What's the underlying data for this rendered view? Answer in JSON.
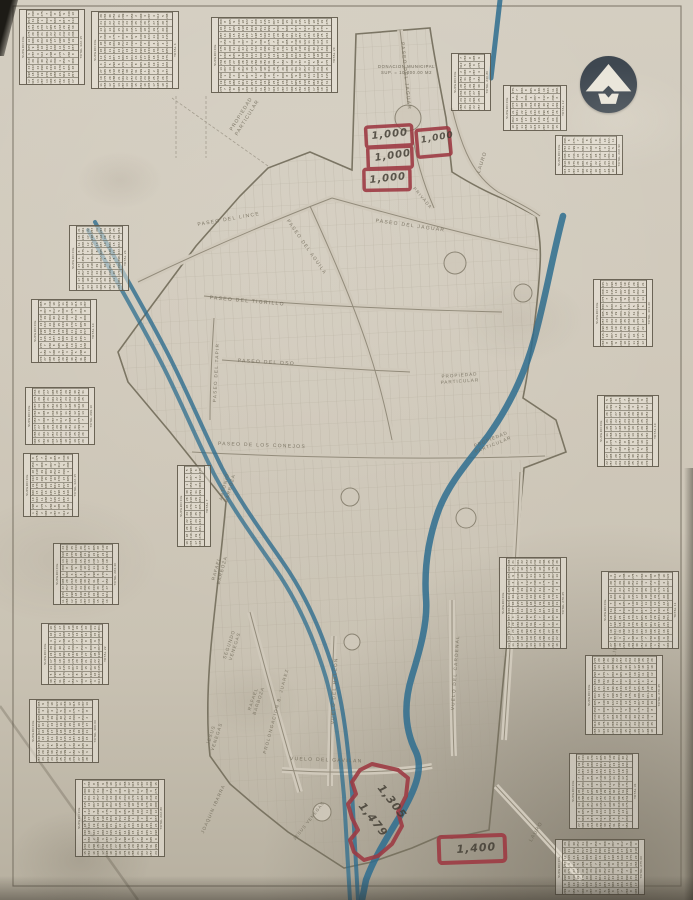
{
  "title_note": {
    "text": "DONACION MUNICIPAL\nSUP. = 10,000.00 M2",
    "x": 378,
    "y": 64,
    "size": 4.2
  },
  "colors": {
    "paper": "#d0c9bb",
    "map_line": "#847d6c",
    "stream_blue": "#2e6d8f",
    "marker_red": "#9d3a43",
    "handwriting": "#443f35",
    "logo": "#3e4750",
    "table_ink": "#49432f"
  },
  "logo": {
    "icon": "arrow-up-emblem"
  },
  "streets": [
    {
      "label": "PASEO DEL JAGUAR",
      "x": 404,
      "y": 42,
      "rot": 84,
      "size": 4.8
    },
    {
      "label": "PASEO DEL LINCE",
      "x": 197,
      "y": 222,
      "rot": -10,
      "size": 5
    },
    {
      "label": "PASEO DEL JAGUAR",
      "x": 376,
      "y": 218,
      "rot": 8,
      "size": 5
    },
    {
      "label": "PRIVADA",
      "x": 416,
      "y": 186,
      "rot": 50,
      "size": 4.2
    },
    {
      "label": "PASEO DEL AGUILA",
      "x": 289,
      "y": 219,
      "rot": 55,
      "size": 4.8
    },
    {
      "label": "PASEO DEL TIGRILLO",
      "x": 210,
      "y": 295,
      "rot": 5,
      "size": 5
    },
    {
      "label": "PASEO DEL TAPIR",
      "x": 212,
      "y": 402,
      "rot": -87,
      "size": 4.6
    },
    {
      "label": "PASEO DEL OSO",
      "x": 238,
      "y": 358,
      "rot": 3,
      "size": 5
    },
    {
      "label": "PASEO DE LOS CONEJOS",
      "x": 218,
      "y": 441,
      "rot": 2,
      "size": 5
    },
    {
      "label": "PROLONGACION B. JUAREZ",
      "x": 262,
      "y": 753,
      "rot": -75,
      "size": 4.4
    },
    {
      "label": "VUELO DEL HALCON",
      "x": 330,
      "y": 724,
      "rot": -87,
      "size": 4.6
    },
    {
      "label": "VUELO DEL GAVILAN",
      "x": 290,
      "y": 756,
      "rot": 2,
      "size": 5
    },
    {
      "label": "VUELO DEL CARDENAL",
      "x": 450,
      "y": 710,
      "rot": -86,
      "size": 4.6
    }
  ],
  "owners": [
    {
      "name": "PROPIEDAD\nPARTICULAR",
      "x": 228,
      "y": 130,
      "rot": -58,
      "size": 5
    },
    {
      "name": "LAURO",
      "x": 476,
      "y": 172,
      "rot": -72,
      "size": 5
    },
    {
      "name": "PROPIEDAD\nPARTICULAR",
      "x": 440,
      "y": 374,
      "rot": -4,
      "size": 4.6
    },
    {
      "name": "PROPIEDAD\nPARTICULAR",
      "x": 472,
      "y": 444,
      "rot": -22,
      "size": 4.6
    },
    {
      "name": "ANTONIO\nBARBOZA",
      "x": 218,
      "y": 500,
      "rot": -75,
      "size": 4.6
    },
    {
      "name": "RAFAEL\nBARBOZA",
      "x": 210,
      "y": 582,
      "rot": -75,
      "size": 4.6
    },
    {
      "name": "SEGUNDO\nVENEGAS",
      "x": 222,
      "y": 658,
      "rot": -72,
      "size": 4.6
    },
    {
      "name": "RAFAEL\nBARBOZA",
      "x": 246,
      "y": 712,
      "rot": -72,
      "size": 4.6
    },
    {
      "name": "JESUS\nVENEGAS",
      "x": 204,
      "y": 748,
      "rot": -72,
      "size": 4.6
    },
    {
      "name": "JOAQUIN IBARRA",
      "x": 200,
      "y": 832,
      "rot": -66,
      "size": 4.6
    },
    {
      "name": "JESUS VENEGAS",
      "x": 292,
      "y": 838,
      "rot": -52,
      "size": 4.2
    },
    {
      "name": "FELIPE NIETO",
      "x": 610,
      "y": 664,
      "rot": -80,
      "size": 5
    },
    {
      "name": "LAURO",
      "x": 528,
      "y": 840,
      "rot": -60,
      "size": 5
    }
  ],
  "red_annotations": {
    "labels": [
      {
        "text": "1,000",
        "x": 371,
        "y": 131,
        "rot": -6,
        "size": 10
      },
      {
        "text": "1,000",
        "x": 374,
        "y": 153,
        "rot": -8,
        "size": 10
      },
      {
        "text": "1,000",
        "x": 369,
        "y": 175,
        "rot": -6,
        "size": 10
      },
      {
        "text": "1,000",
        "x": 420,
        "y": 136,
        "rot": -10,
        "size": 9
      },
      {
        "text": "1,305",
        "x": 385,
        "y": 782,
        "rot": 52,
        "size": 11
      },
      {
        "text": "1,479",
        "x": 366,
        "y": 800,
        "rot": 52,
        "size": 11
      },
      {
        "text": "1,400",
        "x": 456,
        "y": 843,
        "rot": -4,
        "size": 11
      }
    ]
  },
  "tables": {
    "chrome": {
      "header": "SUPERFICIE",
      "total": "TOTAL"
    },
    "digits_pool": "12 315.40 13 287.25 14 300.00 15 262.80 16 245.60 17 198.75 18 310.15 19 275.90 20 288.45 21 301.20 22 257.35 23 242.10 24 296.85 25 233.50 26 270.25 27 305.60 28 218.95 29 284.30 30 252.75 31 299.10 1 350.00 2 300.00 3 287.50 4 312.40 5 298.60 6 275.00 7 260.45 8 305.20 9 240.80 10 322.15 11 268.90",
    "items": [
      {
        "x": 20,
        "y": 10,
        "w": 64,
        "h": 74
      },
      {
        "x": 92,
        "y": 12,
        "w": 86,
        "h": 76
      },
      {
        "x": 212,
        "y": 18,
        "w": 125,
        "h": 74
      },
      {
        "x": 452,
        "y": 54,
        "w": 38,
        "h": 56
      },
      {
        "x": 504,
        "y": 86,
        "w": 62,
        "h": 44
      },
      {
        "x": 556,
        "y": 136,
        "w": 66,
        "h": 38
      },
      {
        "x": 70,
        "y": 226,
        "w": 58,
        "h": 64
      },
      {
        "x": 32,
        "y": 300,
        "w": 64,
        "h": 62
      },
      {
        "x": 26,
        "y": 388,
        "w": 68,
        "h": 56
      },
      {
        "x": 24,
        "y": 454,
        "w": 54,
        "h": 62
      },
      {
        "x": 54,
        "y": 544,
        "w": 64,
        "h": 60
      },
      {
        "x": 42,
        "y": 624,
        "w": 66,
        "h": 60
      },
      {
        "x": 30,
        "y": 700,
        "w": 68,
        "h": 62
      },
      {
        "x": 76,
        "y": 780,
        "w": 88,
        "h": 76
      },
      {
        "x": 178,
        "y": 466,
        "w": 32,
        "h": 80
      },
      {
        "x": 594,
        "y": 280,
        "w": 58,
        "h": 66
      },
      {
        "x": 598,
        "y": 396,
        "w": 60,
        "h": 70
      },
      {
        "x": 500,
        "y": 558,
        "w": 66,
        "h": 90
      },
      {
        "x": 602,
        "y": 572,
        "w": 76,
        "h": 76
      },
      {
        "x": 586,
        "y": 656,
        "w": 76,
        "h": 78
      },
      {
        "x": 570,
        "y": 754,
        "w": 68,
        "h": 74
      },
      {
        "x": 556,
        "y": 840,
        "w": 88,
        "h": 54
      }
    ]
  }
}
